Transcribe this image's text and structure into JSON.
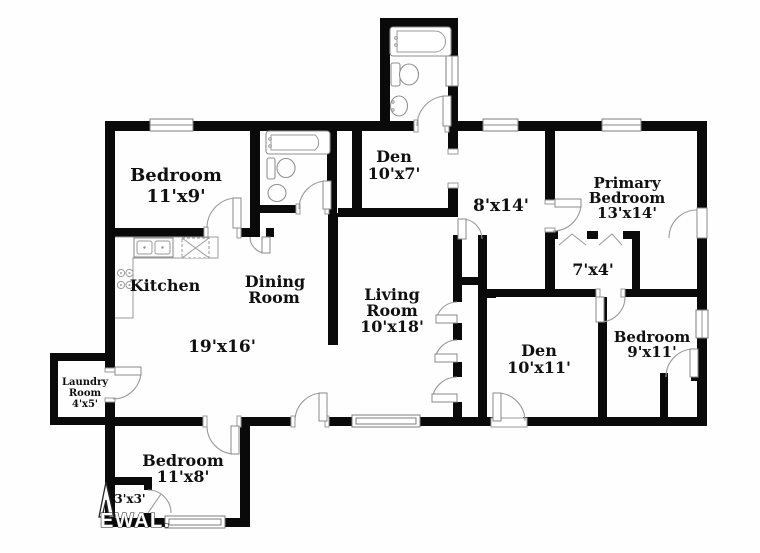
{
  "floor_plan": {
    "rooms": {
      "bedroom_top_left": {
        "name": "Bedroom",
        "dims": "11'x9'"
      },
      "den_top": {
        "name": "Den",
        "dims": "10'x7'"
      },
      "hallway": {
        "dims": "8'x14'"
      },
      "primary_bedroom": {
        "name_line1": "Primary",
        "name_line2": "Bedroom",
        "dims": "13'x14'"
      },
      "kitchen": {
        "name": "Kitchen"
      },
      "dining_room": {
        "name_line1": "Dining",
        "name_line2": "Room"
      },
      "living_room": {
        "name_line1": "Living",
        "name_line2": "Room",
        "dims": "10'x18'"
      },
      "primary_closet": {
        "dims": "7'x4'"
      },
      "great_room": {
        "dims": "19'x16'"
      },
      "den_right": {
        "name": "Den",
        "dims": "10'x11'"
      },
      "bedroom_right": {
        "name": "Bedroom",
        "dims": "9'x11'"
      },
      "laundry_room": {
        "name_line1": "Laundry",
        "name_line2": "Room",
        "dims": "4'x5'"
      },
      "bedroom_bottom": {
        "name": "Bedroom",
        "dims": "11'x8'"
      },
      "small_closet": {
        "dims": "3'x3'"
      }
    },
    "watermark": {
      "text": "EWAL."
    },
    "colors": {
      "wall": "#0a0a0a",
      "background": "#ffffff",
      "fixture_stroke": "#8f8f8f",
      "label": "#111111"
    }
  }
}
